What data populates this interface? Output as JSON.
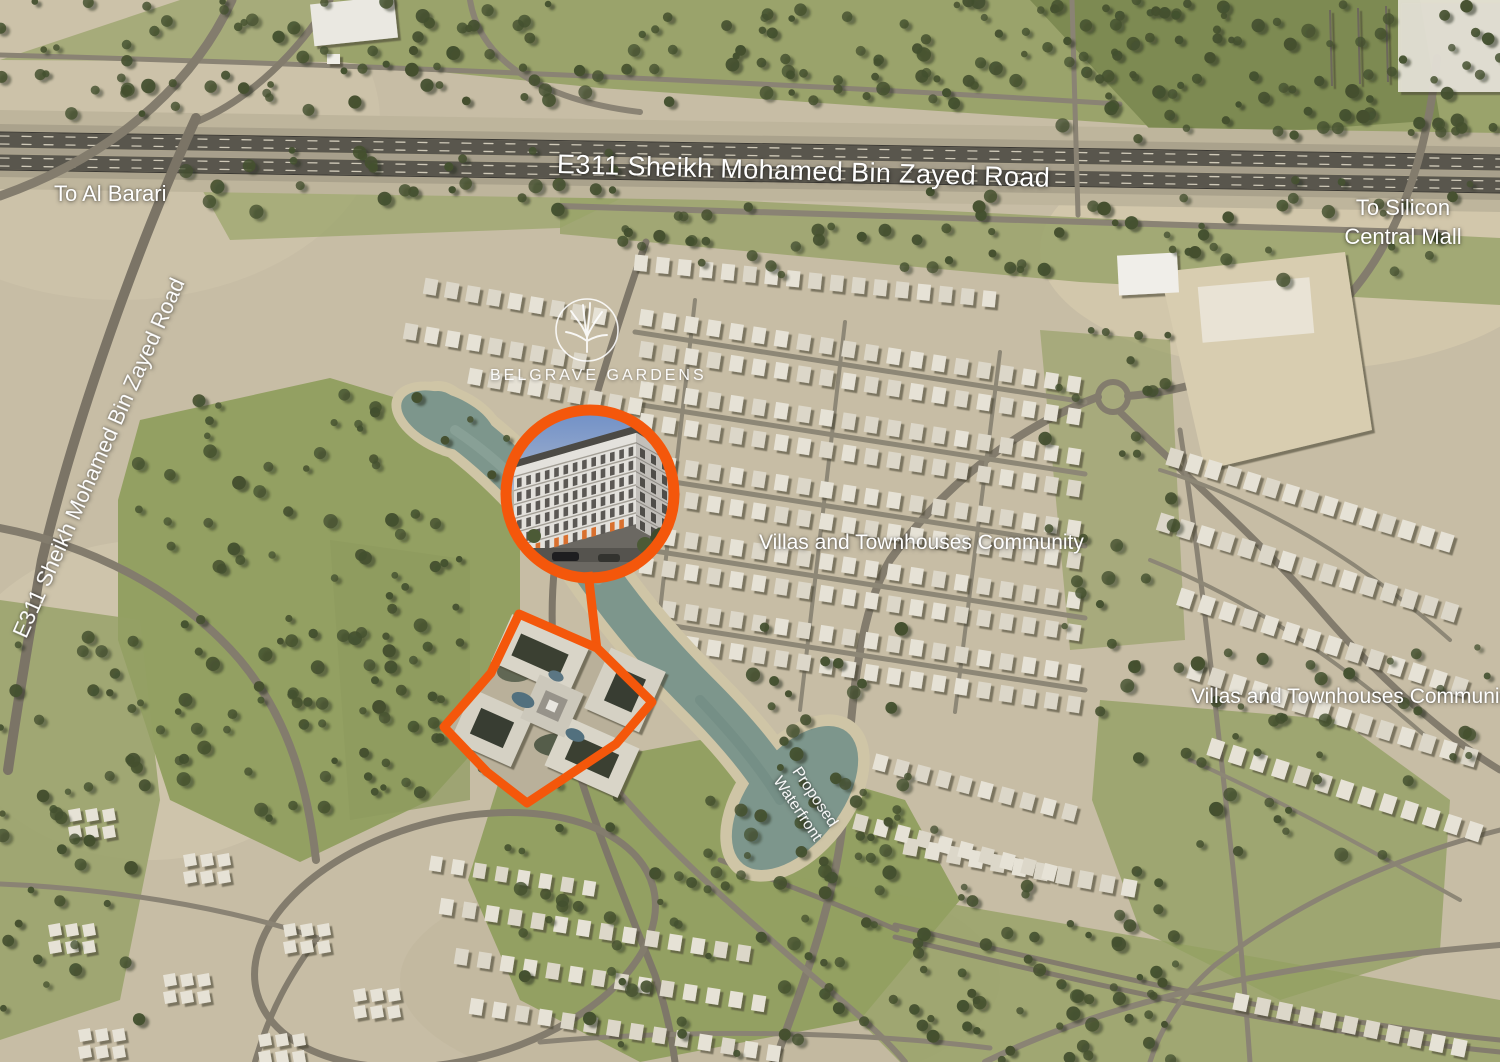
{
  "map": {
    "highway_top_label": "E311 Sheikh Mohamed Bin Zayed Road",
    "highway_left_label": "E311 Sheikh Mohamed Bin Zayed Road",
    "direction_al_barari": "To Al Barari",
    "direction_silicon_line1": "To Silicon",
    "direction_silicon_line2": "Central Mall",
    "community_center": "Villas and Townhouses Community",
    "community_right": "Villas and Townhouses Community",
    "waterfront_line1": "Proposed",
    "waterfront_line2": "Waterfront"
  },
  "brand": {
    "name": "BELGRAVE GARDENS",
    "logo_icon": "tree-in-circle-icon"
  },
  "colors": {
    "accent_orange": "#F4570B",
    "water": "#7D968C",
    "sand": "#C7BDA5",
    "grass": "#9AA36B",
    "grass_dark": "#87935C",
    "tree_dark": "#44502F",
    "road_dark": "#59564D",
    "road_light": "#8A8374",
    "villa_white": "#E6E2D6",
    "label_white": "#FFFFFF"
  }
}
